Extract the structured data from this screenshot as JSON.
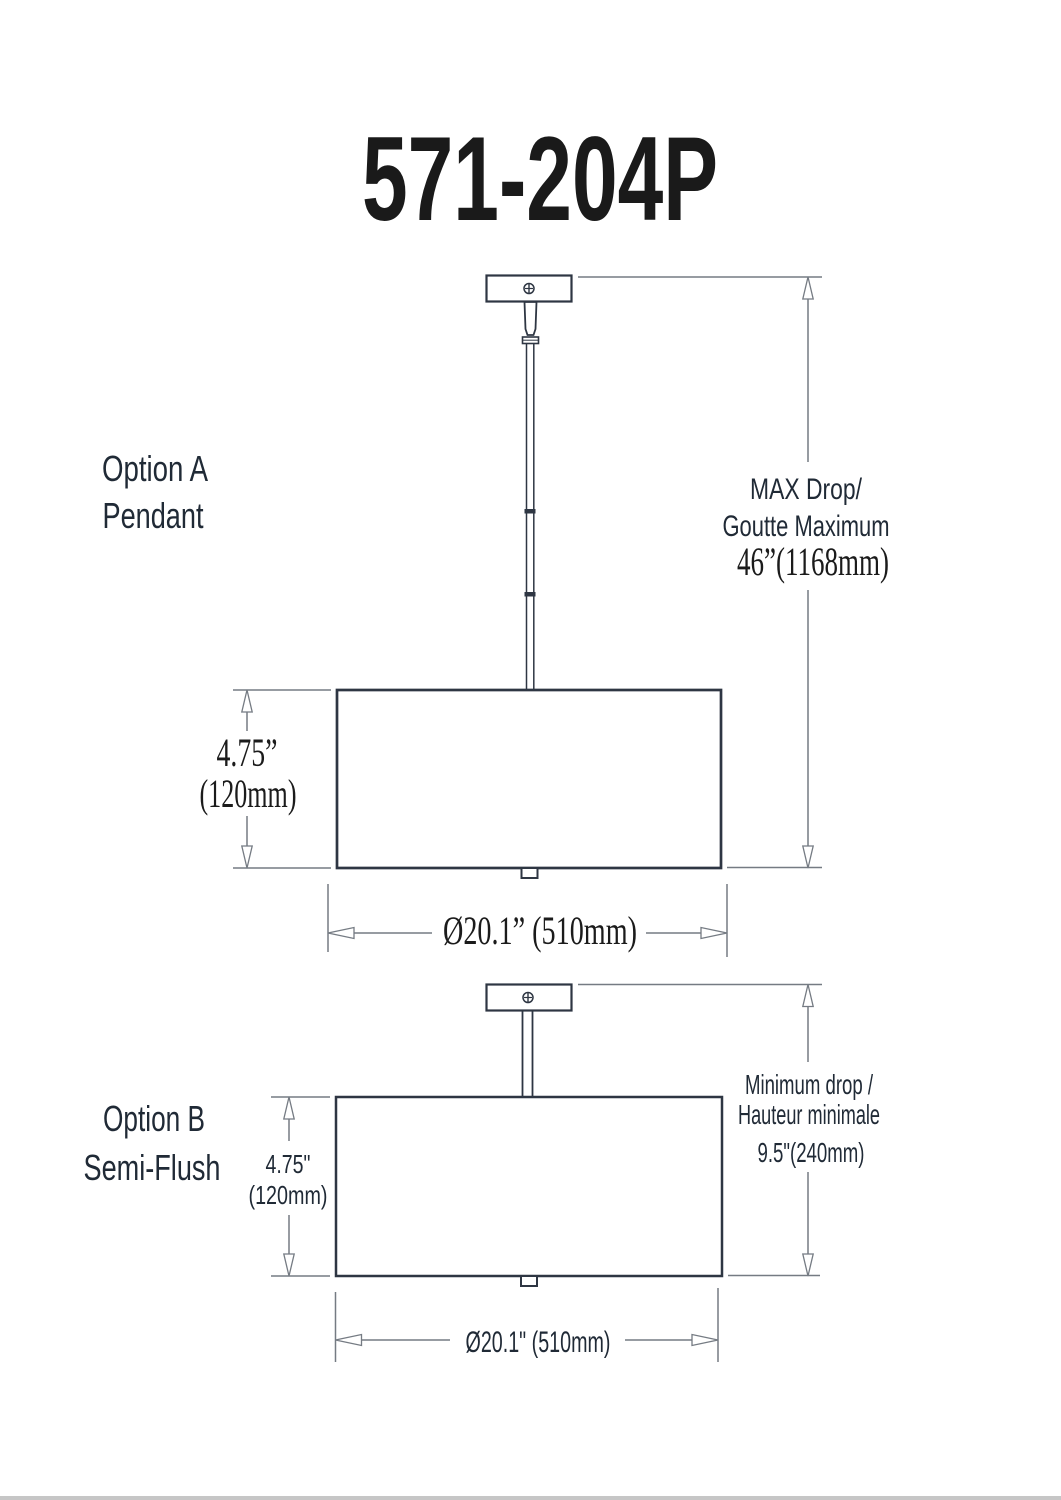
{
  "title": "571-204P",
  "colors": {
    "background": "#ffffff",
    "line": "#2e3643",
    "dim": "#757b83",
    "label": "#202a36",
    "ink": "#1b1b1b"
  },
  "option_a": {
    "label": [
      "Option A",
      "Pendant"
    ],
    "max_drop": [
      "MAX Drop/",
      "Goutte Maximum",
      "46”(1168mm)"
    ],
    "shade_height": [
      "4.75”",
      "(120mm)"
    ],
    "shade_diameter": "Ø20.1” (510mm)"
  },
  "option_b": {
    "label": [
      "Option B",
      "Semi-Flush"
    ],
    "min_drop": [
      "Minimum drop /",
      "Hauteur minimale",
      "9.5\"(240mm)"
    ],
    "shade_height": [
      "4.75\"",
      "(120mm)"
    ],
    "shade_diameter": "Ø20.1\" (510mm)"
  }
}
